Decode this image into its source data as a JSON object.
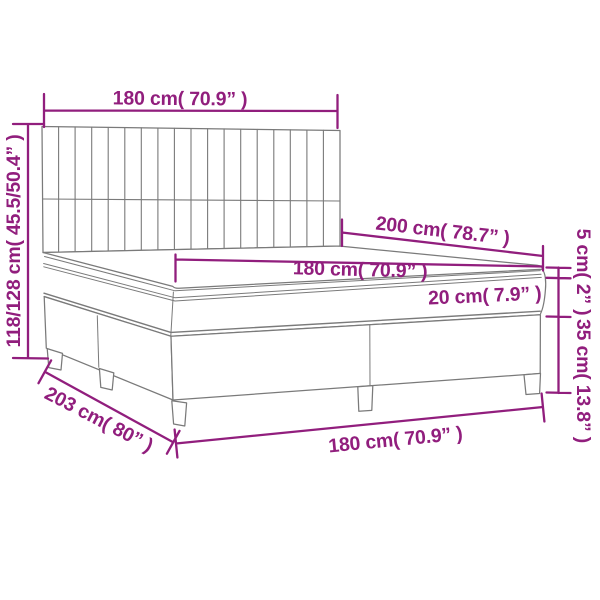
{
  "diagram": {
    "subject": "box-spring-bed-dimension-diagram",
    "labels": {
      "headboard_width": "180 cm( 70.9” )",
      "headboard_height": "118/128 cm( 45.5/50.4” )",
      "bed_length": "200 cm( 78.7” )",
      "mattress_width": "180 cm( 70.9” )",
      "mattress_thickness": "20 cm( 7.9” )",
      "topper_thickness": "5 cm( 2” )",
      "base_height": "35 cm( 13.8” )",
      "total_length": "203 cm( 80” )",
      "base_width": "180 cm( 70.9” )"
    },
    "colors": {
      "dimension": "#911E7D",
      "outline": "#7A7A7A",
      "background": "#FFFFFF"
    }
  }
}
